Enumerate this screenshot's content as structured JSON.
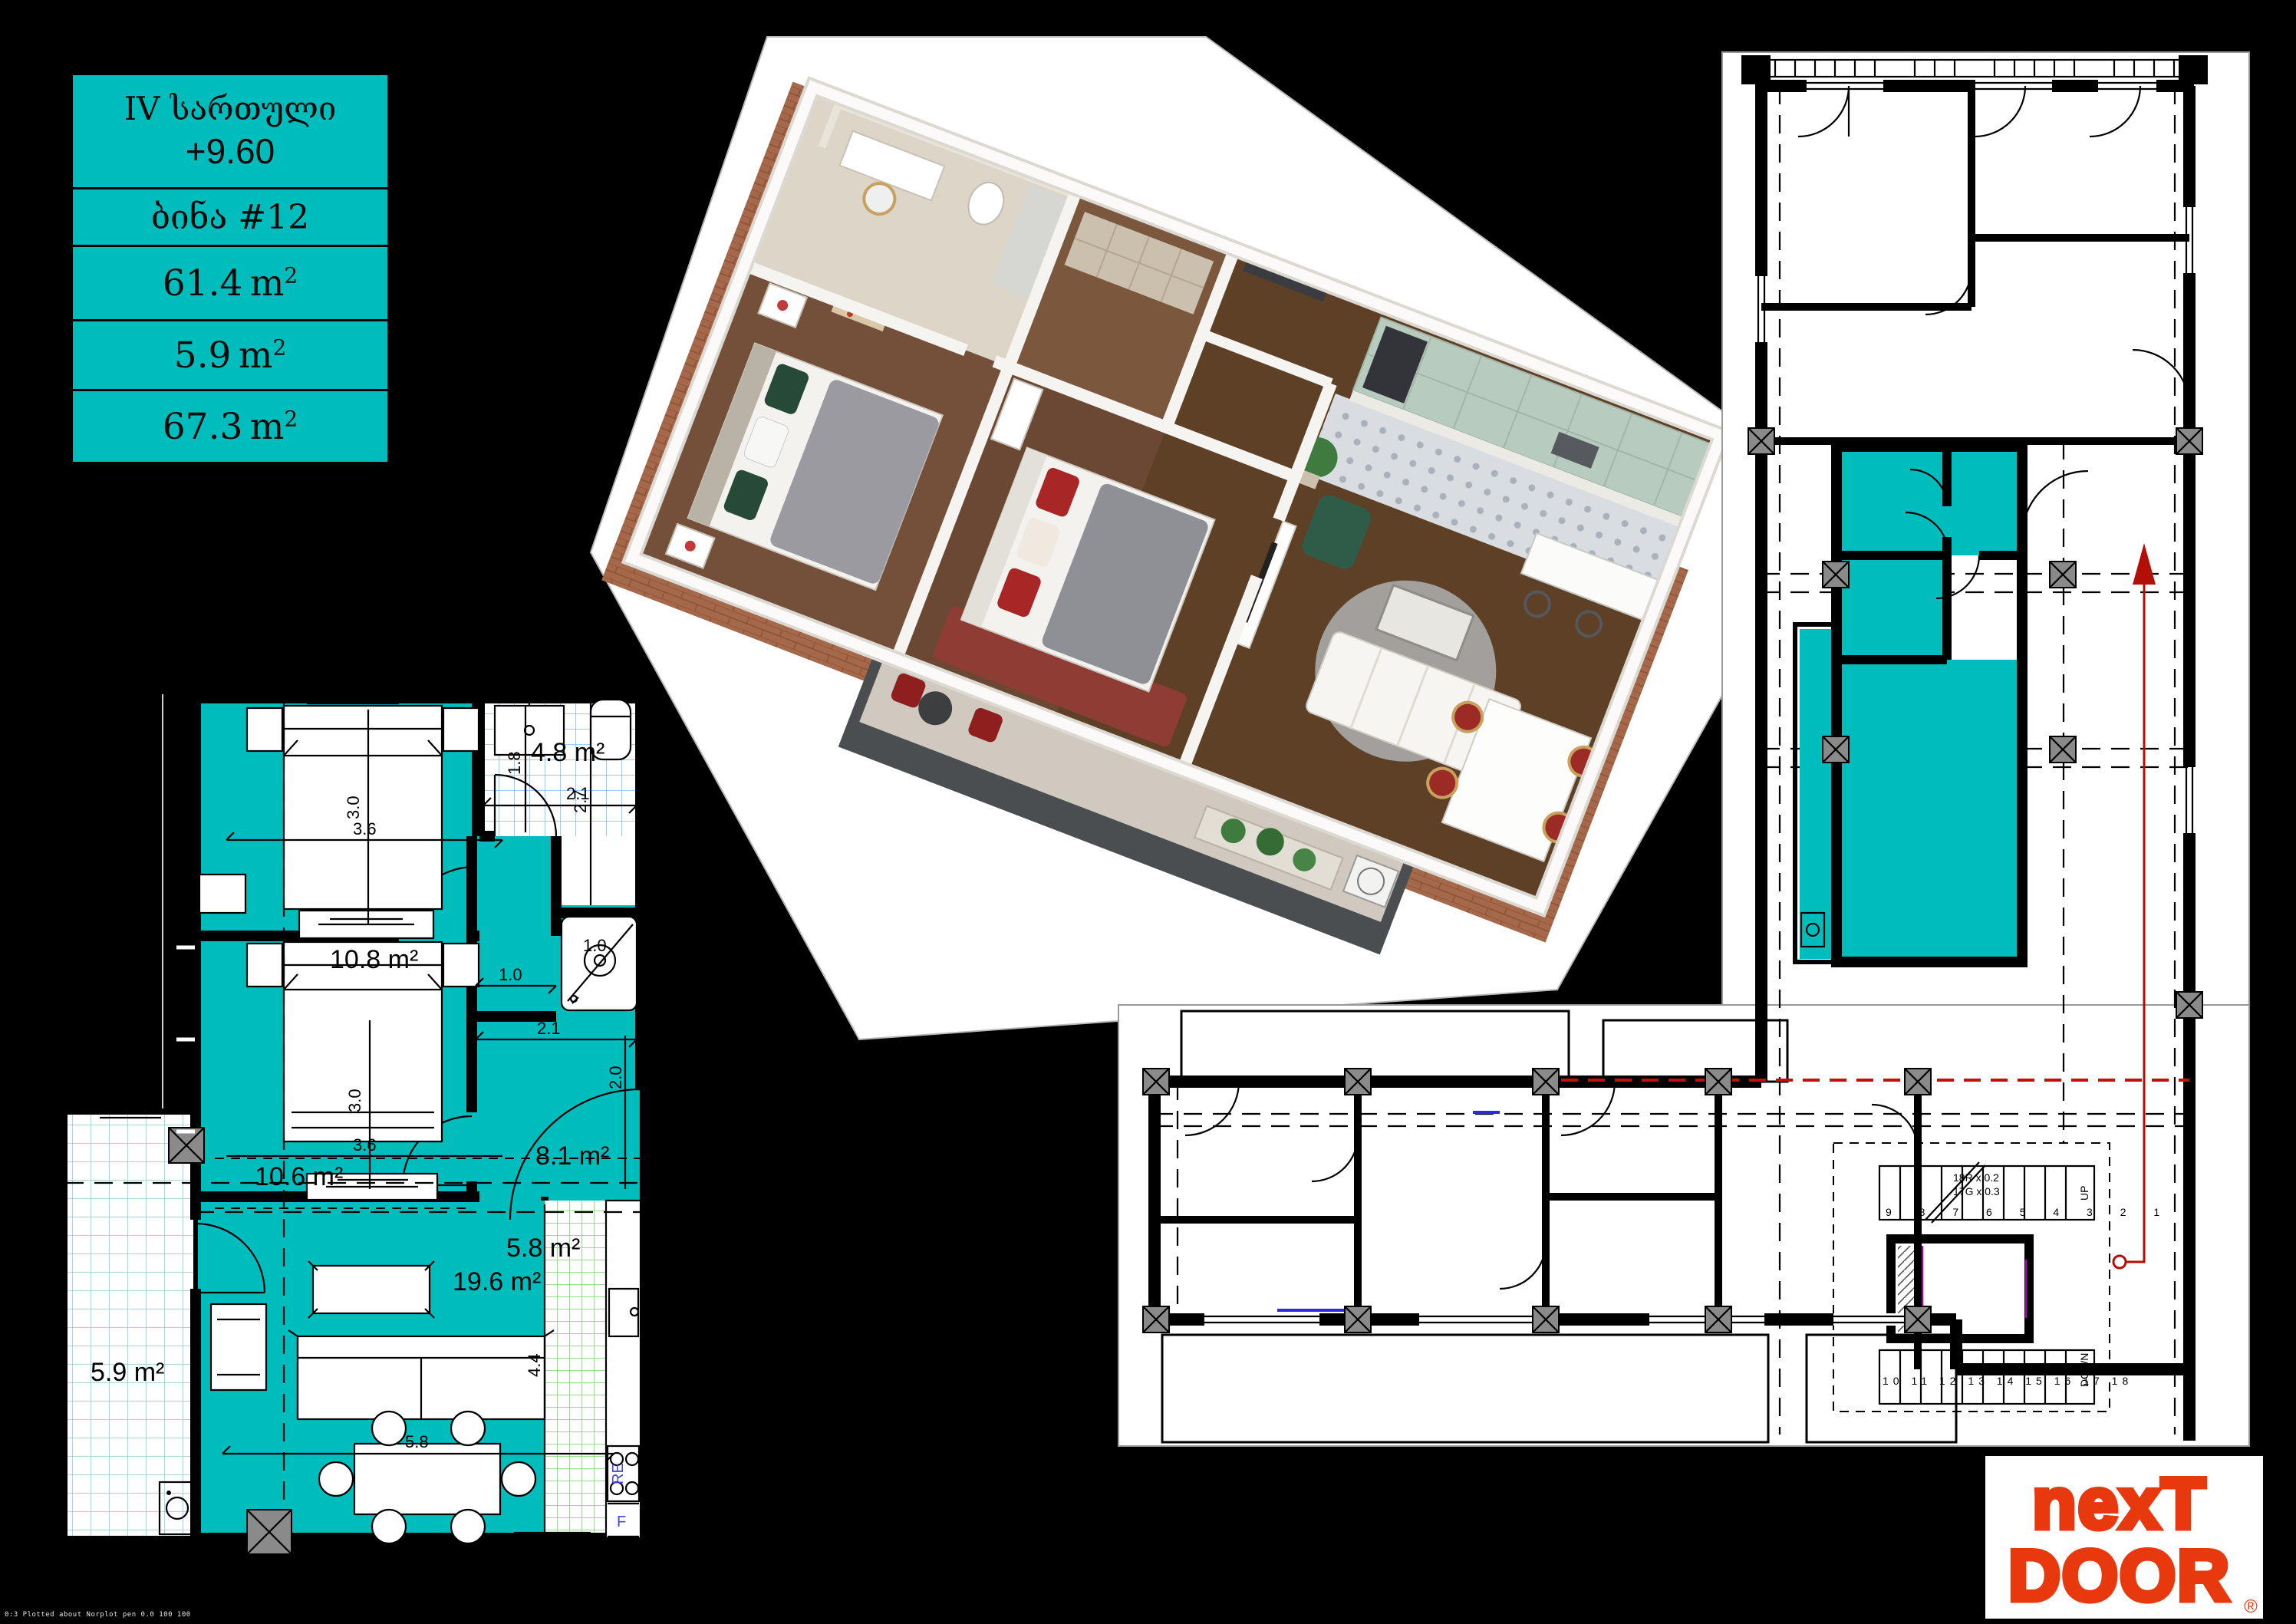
{
  "colors": {
    "teal": "#00bdbd",
    "logo-red": "#e8380d",
    "arrow-red": "#b40f06",
    "grid-blue": "#8fb9e6",
    "grid-green": "#86c97e",
    "balcony-grid": "#9cc9cf",
    "brick": "#a5684a",
    "mint": "#b7ccbf",
    "wood": "#6f4c31"
  },
  "info_panel": {
    "floor": "IV სართული",
    "level": "+9.60",
    "apartment": "ბინა #12",
    "areas": [
      {
        "value": "61.4",
        "unit": "m",
        "exp": "2"
      },
      {
        "value": "5.9",
        "unit": "m",
        "exp": "2"
      },
      {
        "value": "67.3",
        "unit": "m",
        "exp": "2"
      }
    ]
  },
  "plan2d": {
    "rooms": {
      "bedroom1": "10.8 m²",
      "bathroom": "4.8 m²",
      "hall": "8.1 m²",
      "bedroom2": "10.6 m²",
      "living": "19.6 m²",
      "kitchen": "5.8 m²",
      "balcony": "5.9 m²"
    },
    "dims": {
      "bed1_w": "3.6",
      "bed1_h": "3.0",
      "bath_h": "1.8",
      "bath_w": "2.1",
      "bath_d": "2.7",
      "shower": "1.0",
      "hall_pass": "1.0",
      "hall_w": "2.1",
      "hall_h": "2.0",
      "bed2_w": "3.6",
      "bed2_h": "3.0",
      "living_w": "5.8",
      "living_h": "4.4"
    },
    "appliances": {
      "range": "RE",
      "fridge": "F"
    }
  },
  "building_plan": {
    "stairs": {
      "up": "UP",
      "down": "DOWN",
      "note1": "18R x 0.2",
      "note2": "17G x 0.3",
      "up_numbers": "9 8 7 6 5 4 3 2 1",
      "down_numbers": "10 11 12 13 14 15 16 17 18"
    }
  },
  "logo": {
    "line1": "nexT",
    "line2": "DOOR",
    "registered": "®"
  },
  "footer": {
    "plot_stamp": "0:3 Plotted about Norplot pen 0.0 100 100"
  }
}
